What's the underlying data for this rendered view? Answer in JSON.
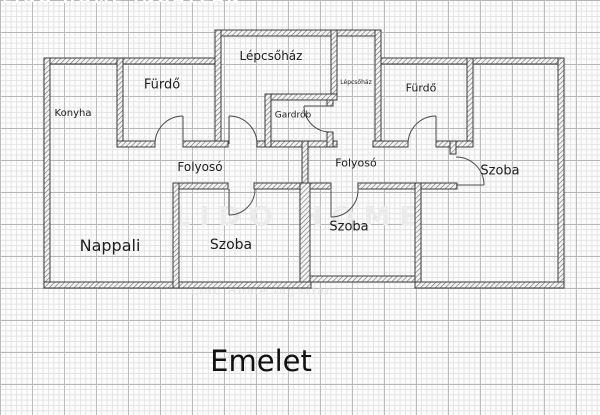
{
  "title": "Emelet",
  "watermarks": {
    "top": "LIDO HOME INGATLAN",
    "middle": "LIDO HOME",
    "bottom": "Lido Home Ingatlan"
  },
  "rooms": {
    "konyha": "Konyha",
    "furdo_left": "Fürdő",
    "lepcsohaz": "Lépcsőház",
    "lepcsohaz_small": "Lépcsőház",
    "gardrob": "Gardrób",
    "furdo_right": "Fürdő",
    "folyoso_left": "Folyosó",
    "folyoso_right": "Folyosó",
    "szoba_right": "Szoba",
    "nappali": "Nappali",
    "szoba_center": "Szoba",
    "szoba_mid": "Szoba"
  },
  "colors": {
    "wall_outline": "#3c3c3c",
    "wall_hatch": "#6a6a6a",
    "door_line": "#4a4a4a",
    "grid_major": "#b6b6b6",
    "grid_minor": "#e3e3e3"
  }
}
